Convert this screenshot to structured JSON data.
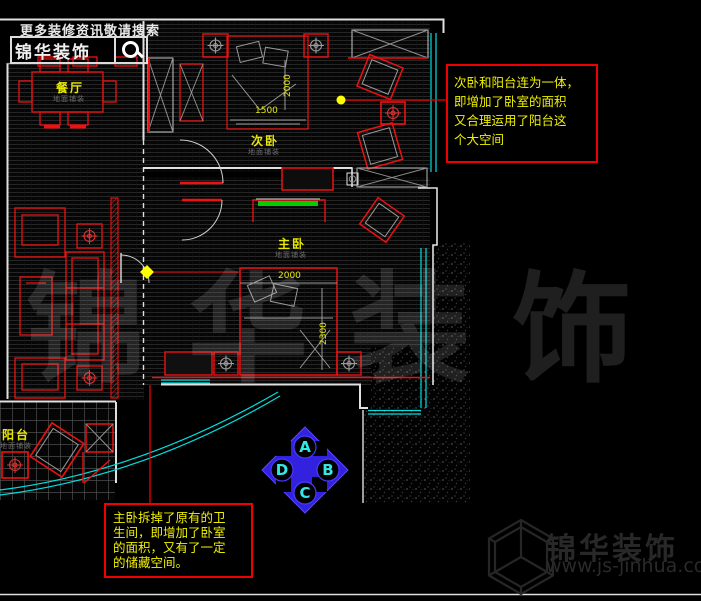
{
  "header": {
    "search_hint": "更多装修资讯敬请搜索",
    "brand": "锦华装饰",
    "search_icon": "magnifier"
  },
  "plan": {
    "rooms": [
      {
        "name": "餐厅",
        "sub": "地面铺装"
      },
      {
        "name": "次卧",
        "sub": "地面铺装"
      },
      {
        "name": "主卧",
        "sub": "地面铺装"
      },
      {
        "name": "阳台",
        "sub": "地面铺装"
      }
    ],
    "dimensions": {
      "secondary_bed_width": "1500",
      "secondary_bed_length": "2000",
      "master_bed_width": "2000",
      "master_bed_length": "2300"
    }
  },
  "annotations": {
    "secondary_bedroom_note": {
      "lines": [
        "次卧和阳台连为一体，",
        "即增加了卧室的面积",
        "又合理运用了阳台这",
        "个大空间"
      ]
    },
    "master_bedroom_note": {
      "lines": [
        "主卧拆掉了原有的卫",
        "生间，即增加了卧室",
        "的面积，又有了一定",
        "的储藏空间。"
      ]
    }
  },
  "compass": {
    "top": "A",
    "right": "B",
    "bottom": "C",
    "left": "D"
  },
  "watermark": {
    "text": "锦华装饰"
  },
  "footer": {
    "brand": "锦华装饰",
    "url": "www.js-jinhua.com",
    "logo_icon": "hexagon-cube"
  },
  "colors": {
    "wall": "#e8e8e8",
    "furniture": "#ff1414",
    "window": "#00e0e0",
    "label": "#e8e800",
    "note_text": "#f0f000",
    "note_border": "#f00000",
    "compass_fill": "#3222e0",
    "compass_letter": "#35e8e8",
    "tv_green": "#00cc00",
    "watermark": "#232323"
  }
}
